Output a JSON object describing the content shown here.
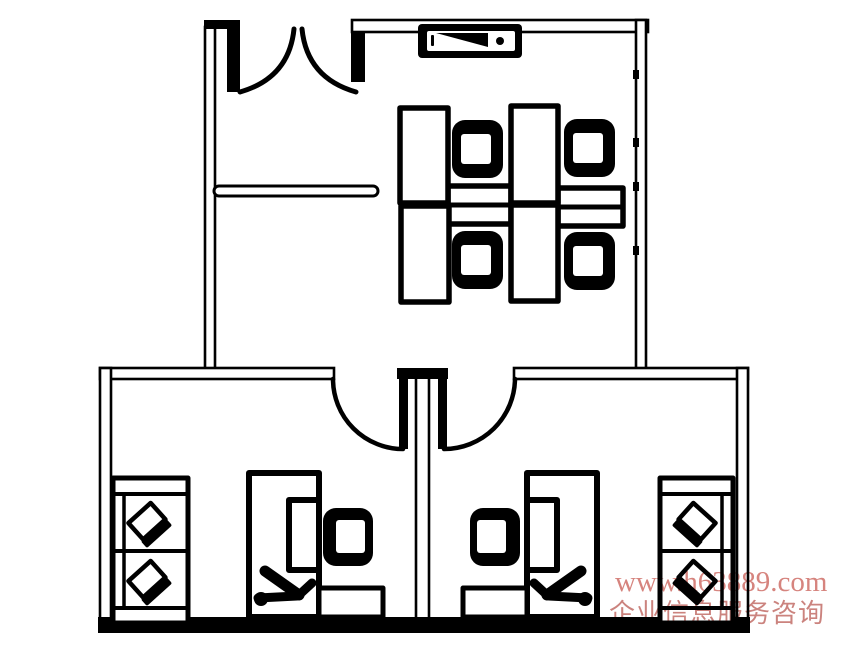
{
  "watermark": {
    "url": "www.h63889.com",
    "caption": "企业信息服务咨询"
  },
  "colors": {
    "watermark_url": "#d6847e",
    "watermark_caption": "#cb837e",
    "line": "#000000",
    "background": "#ffffff"
  },
  "icons": {
    "legend": [
      "double-door-icon",
      "interior-door-icon",
      "tv-screen-icon",
      "workstation-desk-icon",
      "office-chair-icon",
      "monitor-icon",
      "drawer-pedestal-icon",
      "cabinet-shelf-icon",
      "laptop-icon",
      "chair-silhouette-icon",
      "half-wall-divider-icon"
    ]
  }
}
